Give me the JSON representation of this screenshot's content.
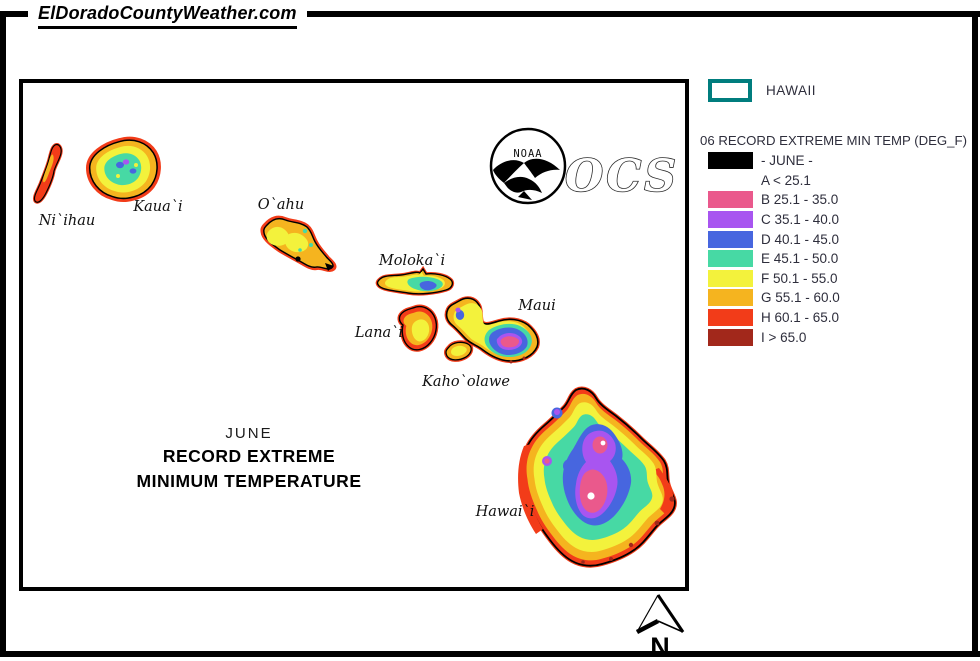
{
  "page": {
    "site_title": "ElDoradoCountyWeather.com"
  },
  "map": {
    "islands": [
      "Ni`ihau",
      "Kaua`i",
      "O`ahu",
      "Moloka`i",
      "Lana`i",
      "Maui",
      "Kaho`olawe",
      "Hawai`i"
    ],
    "title": {
      "line1": "JUNE",
      "line2": "RECORD EXTREME",
      "line3": "MINIMUM TEMPERATURE"
    },
    "noaa_label": "NOAA",
    "ocs_label": "OCS",
    "north_label": "N"
  },
  "legend": {
    "region_label": "HAWAII",
    "heading": "06 RECORD EXTREME MIN TEMP (DEG_F)",
    "rows": [
      {
        "key": "june",
        "label": "- JUNE -",
        "color": "#000000"
      },
      {
        "key": "A",
        "label": "A < 25.1",
        "color": null
      },
      {
        "key": "B",
        "label": "B 25.1 - 35.0",
        "color": "#EA598C"
      },
      {
        "key": "C",
        "label": "C 35.1 - 40.0",
        "color": "#A855F0"
      },
      {
        "key": "D",
        "label": "D 40.1 - 45.0",
        "color": "#4766DF"
      },
      {
        "key": "E",
        "label": "E 45.1 - 50.0",
        "color": "#47D9A4"
      },
      {
        "key": "F",
        "label": "F 50.1 - 55.0",
        "color": "#F3F23C"
      },
      {
        "key": "G",
        "label": "G 55.1 - 60.0",
        "color": "#F5B41F"
      },
      {
        "key": "H",
        "label": "H 60.1 - 65.0",
        "color": "#F23C19"
      },
      {
        "key": "I",
        "label": "I > 65.0",
        "color": "#A2281B"
      }
    ]
  },
  "palette": {
    "b": "#EA598C",
    "c": "#A855F0",
    "d": "#4766DF",
    "e": "#47D9A4",
    "f": "#F3F23C",
    "g": "#F5B41F",
    "h": "#F23C19",
    "i": "#A2281B",
    "teal": "#007D7E"
  }
}
